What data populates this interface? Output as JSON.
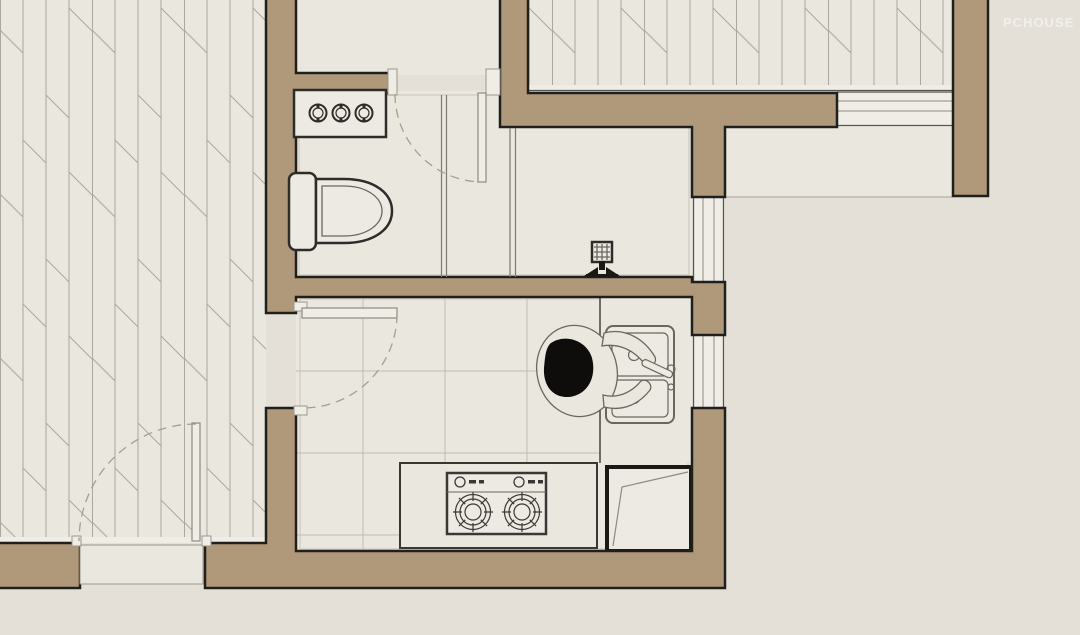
{
  "watermark": {
    "text": "PCHOUSE"
  },
  "scene": "apartment floor plan detail: bathroom, shower room and kitchen",
  "fixtures": [
    "wood-floor-hatch",
    "bathroom-vanity",
    "toilet",
    "shower-floor-drain",
    "shower-valve",
    "glass-partition",
    "door-swing",
    "kitchen-tile-floor",
    "double-bowl-kitchen-sink",
    "faucet-lever",
    "person-at-sink",
    "two-burner-gas-stove",
    "kitchen-counter",
    "refrigerator",
    "window"
  ],
  "colors": {
    "exterior": "#e4e0d8",
    "floor": "#eae7df",
    "floor_light": "#f0ede6",
    "wall_fill": "#b0987a",
    "wall_edge": "#211f1c",
    "hatch": "#aaa79e",
    "tile": "#bfbcb3",
    "hairline": "#c6c3ba",
    "fixture_fill": "#edeae3",
    "fixture_stroke": "#2e2c29",
    "fixture_light": "#6a675f",
    "counter_stroke": "#3a3835",
    "appliance_dark": "#1b1916",
    "arc": "#a39f96",
    "partition": "#7d7a72",
    "window_line": "#55534e",
    "window_line_inner": "#8f8c83",
    "leaf_stroke": "#8d8a81",
    "jamb_stroke": "#9a978e",
    "person_head": "#0e0d0c",
    "ground_line": "#b3b0a7",
    "watermark": "rgba(255,255,255,0.5)"
  }
}
